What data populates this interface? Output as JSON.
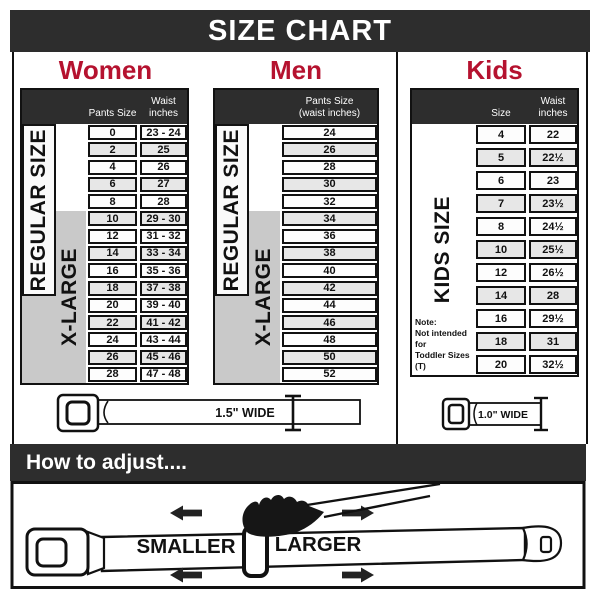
{
  "title": "SIZE CHART",
  "colors": {
    "accent": "#b5122f",
    "bar": "#2d2d2d",
    "xlarge_gray": "#c9c9c9",
    "row_alt": "#e7e7e7"
  },
  "women": {
    "title": "Women",
    "size_header": "Pants Size",
    "waist_header_line1": "Waist",
    "waist_header_line2": "inches",
    "regular_label": "REGULAR SIZE",
    "xlarge_label": "X-LARGE",
    "rows": [
      {
        "size": "0",
        "waist": "23 - 24"
      },
      {
        "size": "2",
        "waist": "25"
      },
      {
        "size": "4",
        "waist": "26"
      },
      {
        "size": "6",
        "waist": "27"
      },
      {
        "size": "8",
        "waist": "28"
      },
      {
        "size": "10",
        "waist": "29 - 30"
      },
      {
        "size": "12",
        "waist": "31 - 32"
      },
      {
        "size": "14",
        "waist": "33 - 34"
      },
      {
        "size": "16",
        "waist": "35 - 36"
      },
      {
        "size": "18",
        "waist": "37 - 38"
      },
      {
        "size": "20",
        "waist": "39 - 40"
      },
      {
        "size": "22",
        "waist": "41 - 42"
      },
      {
        "size": "24",
        "waist": "43 - 44"
      },
      {
        "size": "26",
        "waist": "45 - 46"
      },
      {
        "size": "28",
        "waist": "47 - 48"
      }
    ]
  },
  "men": {
    "title": "Men",
    "header_line1": "Pants Size",
    "header_line2": "(waist inches)",
    "regular_label": "REGULAR SIZE",
    "xlarge_label": "X-LARGE",
    "rows": [
      "24",
      "26",
      "28",
      "30",
      "32",
      "34",
      "36",
      "38",
      "40",
      "42",
      "44",
      "46",
      "48",
      "50",
      "52"
    ]
  },
  "kids": {
    "title": "Kids",
    "size_header": "Size",
    "waist_header_line1": "Waist",
    "waist_header_line2": "inches",
    "label": "KIDS SIZE",
    "note_lines": [
      "Note:",
      "Not intended for",
      "Toddler Sizes (T)"
    ],
    "rows": [
      {
        "size": "4",
        "waist": "22"
      },
      {
        "size": "5",
        "waist": "22½"
      },
      {
        "size": "6",
        "waist": "23"
      },
      {
        "size": "7",
        "waist": "23½"
      },
      {
        "size": "8",
        "waist": "24½"
      },
      {
        "size": "10",
        "waist": "25½"
      },
      {
        "size": "12",
        "waist": "26½"
      },
      {
        "size": "14",
        "waist": "28"
      },
      {
        "size": "16",
        "waist": "29½"
      },
      {
        "size": "18",
        "waist": "31"
      },
      {
        "size": "20",
        "waist": "32½"
      }
    ]
  },
  "belts": {
    "adult_width_label": "1.5\" WIDE",
    "kids_width_label": "1.0\" WIDE"
  },
  "adjust": {
    "header": "How to adjust....",
    "smaller_label": "SMALLER",
    "larger_label": "LARGER"
  }
}
